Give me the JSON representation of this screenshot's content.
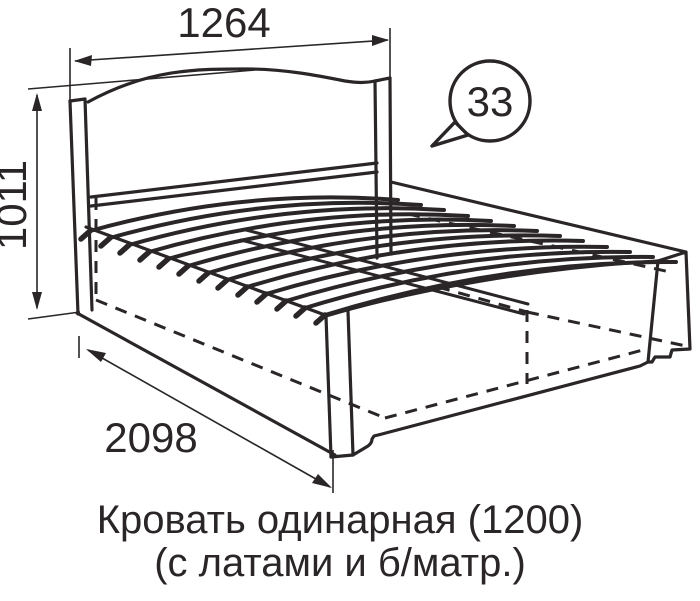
{
  "diagram": {
    "title_caption": {
      "line1": "Кровать одинарная (1200)",
      "line2": "(с латами и б/матр.)"
    },
    "dimensions": {
      "headboard_width": "1264",
      "headboard_height": "1011",
      "bed_length": "2098"
    },
    "callout": {
      "number": "33"
    },
    "colors": {
      "line": "#2a2627",
      "background": "#ffffff"
    }
  }
}
